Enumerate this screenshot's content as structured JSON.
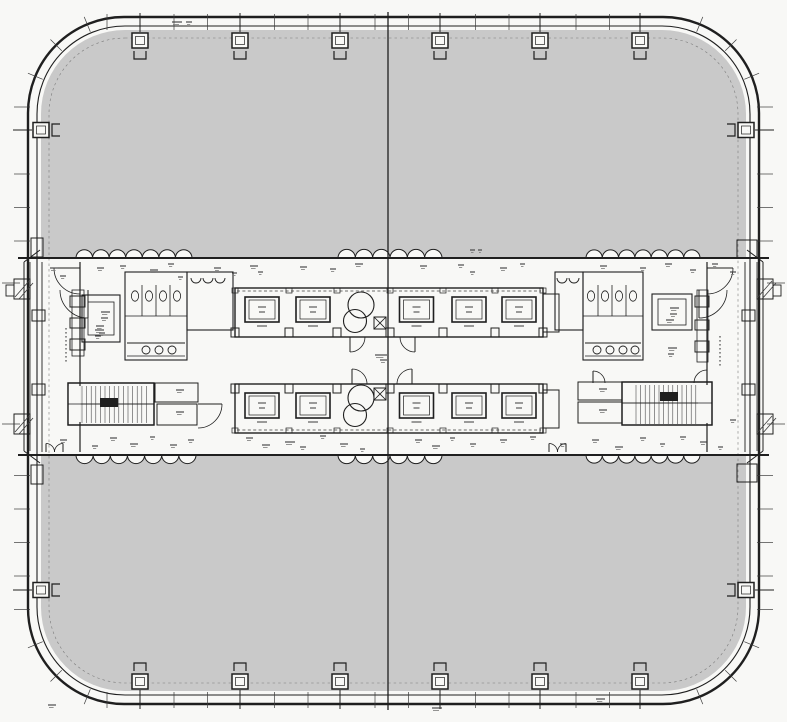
{
  "meta": {
    "drawing_type": "Typical floor plan - square high-rise office tower with rounded corners and central service core",
    "readable_text": "none (all room annotations are illegible micro text in the scan)"
  },
  "palette": {
    "paper": "#f8f8f6",
    "office_fill": "#c9c9c9",
    "ink": "#1f1f1f",
    "soft": "#3c3c3c",
    "faint": "#7a7a7a"
  },
  "canvas": {
    "w": 787,
    "h": 722
  },
  "outline": {
    "outer": [
      28,
      17,
      731,
      687,
      96,
      2.4
    ],
    "inner": [
      37,
      26,
      713,
      669,
      88,
      1.1
    ],
    "gray": [
      41,
      30,
      705,
      661,
      84
    ],
    "dashed": [
      49,
      38,
      689,
      645,
      76
    ]
  },
  "grid": {
    "center_x": 388,
    "stub_ys": [
      283,
      424
    ]
  },
  "core": {
    "band": [
      18,
      258,
      751,
      197
    ],
    "lines": [
      [
        18,
        258,
        769,
        258,
        2.0
      ],
      [
        18,
        455,
        769,
        455,
        2.0
      ],
      [
        42,
        262,
        42,
        452,
        0.9
      ],
      [
        745,
        262,
        745,
        452,
        0.9
      ],
      [
        80,
        262,
        80,
        452,
        1.2
      ],
      [
        707,
        262,
        707,
        452,
        1.2
      ],
      [
        24,
        262,
        24,
        451,
        1.0
      ],
      [
        30,
        262,
        30,
        451,
        0.8
      ],
      [
        763,
        262,
        763,
        451,
        1.0
      ],
      [
        757,
        262,
        757,
        451,
        0.8
      ],
      [
        24,
        262,
        40,
        250,
        1.0
      ],
      [
        24,
        451,
        40,
        463,
        1.0
      ],
      [
        763,
        262,
        747,
        250,
        1.0
      ],
      [
        763,
        451,
        747,
        463,
        1.0
      ],
      [
        125,
        316,
        187,
        316,
        0.8
      ],
      [
        583,
        316,
        643,
        316,
        0.8
      ],
      [
        127,
        343,
        185,
        343,
        0.9
      ],
      [
        127,
        356,
        185,
        356,
        0.7
      ],
      [
        585,
        343,
        641,
        343,
        0.9
      ],
      [
        585,
        356,
        641,
        356,
        0.7
      ],
      [
        68,
        404,
        154,
        404,
        0.8
      ],
      [
        622,
        403,
        712,
        403,
        0.8
      ]
    ],
    "rects": [
      [
        82,
        295,
        38,
        47,
        1.1
      ],
      [
        88,
        302,
        26,
        33,
        0.8
      ],
      [
        125,
        272,
        62,
        88,
        1.1
      ],
      [
        187,
        272,
        46,
        58,
        1.1
      ],
      [
        652,
        294,
        40,
        36,
        1.1
      ],
      [
        658,
        299,
        28,
        26,
        0.8
      ],
      [
        583,
        272,
        60,
        88,
        1.1
      ],
      [
        555,
        272,
        28,
        58,
        1.1
      ],
      [
        155,
        383,
        43,
        19,
        1.0
      ],
      [
        157,
        404,
        40,
        21,
        1.0
      ],
      [
        578,
        382,
        44,
        18,
        1.0
      ],
      [
        578,
        402,
        44,
        21,
        1.0
      ],
      [
        72,
        290,
        12,
        66,
        0.8
      ],
      [
        70,
        296,
        15,
        11,
        1.0
      ],
      [
        70,
        318,
        15,
        10,
        1.0
      ],
      [
        70,
        339,
        15,
        11,
        1.0
      ],
      [
        697,
        290,
        11,
        72,
        0.8
      ],
      [
        695,
        296,
        14,
        11,
        1.0
      ],
      [
        695,
        320,
        14,
        10,
        1.0
      ],
      [
        695,
        341,
        14,
        11,
        1.0
      ],
      [
        32,
        310,
        13,
        11,
        1.0
      ],
      [
        32,
        384,
        13,
        11,
        1.0
      ],
      [
        742,
        310,
        13,
        11,
        1.0
      ],
      [
        742,
        384,
        13,
        11,
        1.0
      ],
      [
        31,
        238,
        12,
        19,
        1.0
      ],
      [
        737,
        240,
        20,
        18,
        1.0
      ],
      [
        31,
        465,
        12,
        19,
        1.0
      ],
      [
        737,
        464,
        20,
        18,
        1.0
      ],
      [
        14,
        279,
        16,
        20,
        1.0
      ],
      [
        6,
        285,
        8,
        11,
        0.9
      ],
      [
        14,
        414,
        16,
        20,
        1.0
      ],
      [
        757,
        279,
        16,
        20,
        1.0
      ],
      [
        773,
        285,
        8,
        11,
        0.9
      ],
      [
        757,
        414,
        16,
        20,
        1.0
      ]
    ],
    "diag_hatch": [
      [
        15,
        297,
        29,
        281
      ],
      [
        19,
        299,
        33,
        283
      ],
      [
        15,
        432,
        29,
        416
      ],
      [
        19,
        434,
        33,
        418
      ],
      [
        758,
        297,
        772,
        281
      ],
      [
        762,
        299,
        776,
        283
      ],
      [
        758,
        432,
        772,
        416
      ],
      [
        762,
        434,
        776,
        418
      ]
    ],
    "partitions": {
      "left_xs": [
        142,
        156,
        170
      ],
      "right_xs": [
        598,
        612,
        626
      ],
      "y1": 285,
      "y2": 316,
      "toilet_left_xs": [
        135,
        149,
        163,
        177
      ],
      "toilet_right_xs": [
        591,
        605,
        619,
        633
      ],
      "toilet_y": 296,
      "sink_left_xs": [
        146,
        159,
        172
      ],
      "sink_right_xs": [
        597,
        610,
        623,
        635
      ],
      "sink_y": 350,
      "urinal_left_xs": [
        196,
        208,
        220
      ],
      "urinal_right_xs": [
        562,
        574
      ],
      "urinal_y": 278
    }
  },
  "stairs": [
    {
      "rect": [
        68,
        383,
        86,
        42
      ],
      "hatch_x1": 82,
      "hatch_x2": 150,
      "y1": 386,
      "y2": 423,
      "mid_y": 404,
      "landing": [
        68.8,
        386,
        12,
        36
      ],
      "arrow": [
        100,
        398,
        18,
        9
      ]
    },
    {
      "rect": [
        622,
        382,
        90,
        43
      ],
      "hatch_x1": 636,
      "hatch_x2": 696,
      "y1": 385,
      "y2": 424,
      "mid_y": 403,
      "landing": [
        698,
        385,
        13,
        38
      ],
      "arrow": [
        660,
        392,
        18,
        9
      ]
    }
  ],
  "elevator_bank": {
    "x_bounds": [
      235,
      289,
      337,
      390,
      443,
      495,
      543
    ],
    "machine_idx": 2,
    "end_cell": {
      "x": 543,
      "w": 16,
      "dy": 6,
      "h": 38
    },
    "rows": [
      {
        "y": 288,
        "h": 49,
        "dash_y": 291,
        "boxes_edge": "bottom",
        "notch_edge": "top",
        "fan_dy": 29,
        "circles": [
          17,
          33
        ]
      },
      {
        "y": 384,
        "h": 49,
        "dash_y": 430,
        "boxes_edge": "top",
        "notch_edge": "bottom",
        "fan_dy": 4,
        "circles": [
          14,
          31
        ]
      }
    ]
  },
  "scallops": {
    "radius": 8.4,
    "top_groups": [
      [
        76,
        192
      ],
      [
        338,
        442
      ],
      [
        586,
        700
      ]
    ],
    "bottom_groups": [
      [
        76,
        196
      ],
      [
        338,
        442
      ],
      [
        586,
        700
      ]
    ]
  },
  "column_markers": {
    "top_xs": [
      140,
      240,
      340,
      440,
      540,
      640
    ],
    "bottom_xs": [
      140,
      240,
      340,
      440,
      540,
      640
    ],
    "left_ys": [
      130,
      590
    ],
    "right_ys": [
      130,
      590
    ]
  },
  "perimeter_ticks": {
    "h_from": 107,
    "h_to": 676,
    "v_from": 107,
    "v_to": 640,
    "step": 33.5,
    "skip_margin": 12,
    "core_gap": [
      255,
      460
    ]
  },
  "corners": [
    {
      "cx": 124,
      "cy": 113,
      "quad": "TL"
    },
    {
      "cx": 663,
      "cy": 113,
      "quad": "TR"
    },
    {
      "cx": 124,
      "cy": 608,
      "quad": "BL"
    },
    {
      "cx": 663,
      "cy": 608,
      "quad": "BR"
    }
  ],
  "doors": [
    {
      "leaf": [
        350,
        337,
        350,
        352
      ],
      "arc": "M350,352 A15,15 0 0 0 365,337"
    },
    {
      "leaf": [
        415,
        337,
        415,
        352
      ],
      "arc": "M415,352 A15,15 0 0 1 400,337"
    },
    {
      "leaf": [
        352,
        384,
        352,
        369
      ],
      "arc": "M352,369 A15,15 0 0 1 367,384"
    },
    {
      "leaf": [
        412,
        384,
        412,
        369
      ],
      "arc": "M412,369 A15,15 0 0 0 397,384"
    },
    {
      "leaf": [
        88,
        290,
        88,
        318
      ],
      "arc": "M88,318 A28,28 0 0 1 60,290"
    },
    {
      "leaf": [
        699,
        290,
        699,
        318
      ],
      "arc": "M699,318 A28,28 0 0 0 727,290"
    },
    {
      "leaf": [
        707,
        268,
        733,
        268
      ],
      "arc": "M733,268 A26,26 0 0 1 707,294"
    },
    {
      "leaf": [
        80,
        268,
        54,
        268
      ],
      "arc": "M54,268 A26,26 0 0 0 80,294"
    },
    {
      "leaf": [
        198,
        404,
        222,
        404
      ],
      "arc": "M222,404 A24,24 0 0 1 198,428"
    },
    {
      "leaf": [
        593,
        371,
        593,
        383
      ],
      "arc": "M593,371 A12,12 0 0 1 605,383"
    },
    {
      "leaf": [
        707,
        370,
        707,
        383
      ],
      "arc": "M707,370 A13,13 0 0 0 694,383"
    },
    {
      "leaf": [
        46,
        452,
        46,
        443.5
      ],
      "arc": "M46,443.5 A8.5,8.5 0 0 1 54.5,452"
    },
    {
      "leaf": [
        63,
        452,
        63,
        443.5
      ],
      "arc": "M63,443.5 A8.5,8.5 0 0 0 54.5,452"
    },
    {
      "leaf": [
        549,
        452,
        549,
        443.5
      ],
      "arc": "M549,443.5 A8.5,8.5 0 0 1 557.5,452"
    },
    {
      "leaf": [
        566,
        452,
        566,
        443.5
      ],
      "arc": "M566,443.5 A8.5,8.5 0 0 0 557.5,452"
    }
  ],
  "micro_labels": [
    [
      50,
      268,
      8
    ],
    [
      60,
      276,
      6
    ],
    [
      97,
      268,
      7
    ],
    [
      120,
      266,
      6
    ],
    [
      150,
      270,
      8
    ],
    [
      168,
      264,
      6
    ],
    [
      178,
      277,
      5
    ],
    [
      214,
      268,
      7
    ],
    [
      232,
      273,
      5
    ],
    [
      250,
      266,
      8
    ],
    [
      258,
      272,
      5
    ],
    [
      300,
      267,
      7
    ],
    [
      330,
      269,
      6
    ],
    [
      355,
      264,
      8
    ],
    [
      420,
      266,
      7
    ],
    [
      458,
      265,
      6
    ],
    [
      470,
      272,
      5
    ],
    [
      500,
      268,
      7
    ],
    [
      520,
      264,
      5
    ],
    [
      600,
      266,
      7
    ],
    [
      640,
      268,
      6
    ],
    [
      665,
      264,
      7
    ],
    [
      690,
      270,
      6
    ],
    [
      712,
      264,
      6
    ],
    [
      60,
      440,
      7
    ],
    [
      92,
      446,
      6
    ],
    [
      110,
      438,
      7
    ],
    [
      130,
      444,
      8
    ],
    [
      150,
      437,
      5
    ],
    [
      170,
      445,
      7
    ],
    [
      188,
      440,
      6
    ],
    [
      246,
      438,
      7
    ],
    [
      262,
      445,
      8
    ],
    [
      285,
      442,
      10
    ],
    [
      300,
      447,
      6
    ],
    [
      320,
      436,
      6
    ],
    [
      340,
      444,
      8
    ],
    [
      360,
      449,
      5
    ],
    [
      415,
      440,
      7
    ],
    [
      432,
      446,
      8
    ],
    [
      450,
      438,
      5
    ],
    [
      470,
      444,
      6
    ],
    [
      500,
      440,
      7
    ],
    [
      530,
      437,
      6
    ],
    [
      560,
      444,
      6
    ],
    [
      592,
      440,
      7
    ],
    [
      615,
      447,
      8
    ],
    [
      640,
      438,
      6
    ],
    [
      660,
      444,
      5
    ],
    [
      680,
      437,
      6
    ],
    [
      700,
      442,
      7
    ],
    [
      718,
      447,
      5
    ],
    [
      101,
      312,
      9
    ],
    [
      101,
      318,
      7
    ],
    [
      96,
      326,
      8
    ],
    [
      99,
      333,
      6
    ],
    [
      670,
      308,
      9
    ],
    [
      670,
      314,
      7
    ],
    [
      666,
      320,
      8
    ],
    [
      176,
      390,
      8
    ],
    [
      176,
      412,
      8
    ],
    [
      599,
      389,
      8
    ],
    [
      599,
      410,
      8
    ],
    [
      375,
      355,
      12
    ],
    [
      380,
      360,
      7
    ],
    [
      95,
      330,
      9
    ],
    [
      95,
      336,
      6
    ],
    [
      668,
      348,
      9
    ],
    [
      668,
      354,
      6
    ],
    [
      172,
      22,
      10
    ],
    [
      186,
      22,
      6
    ],
    [
      432,
      708,
      10
    ],
    [
      596,
      699,
      9
    ],
    [
      48,
      705,
      8
    ],
    [
      730,
      272,
      6
    ],
    [
      730,
      420,
      6
    ],
    [
      470,
      250,
      5
    ],
    [
      478,
      250,
      4
    ]
  ],
  "v_label_dots": [
    [
      66,
      328,
      362
    ],
    [
      720,
      336,
      364
    ]
  ]
}
